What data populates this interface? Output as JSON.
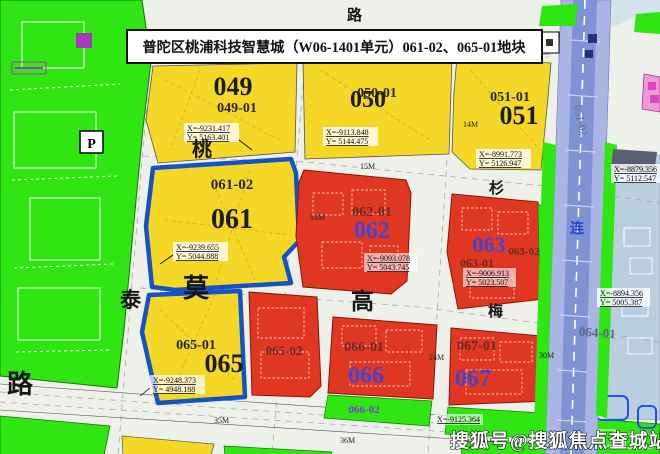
{
  "title": "普陀区桃浦科技智慧城（W06-1401单元）061-02、065-01地块",
  "watermark": "搜狐号@搜狐焦点查城站",
  "colors": {
    "parcel_yellow": "#f5d827",
    "parcel_red": "#e03723",
    "park_green": "#2fe512",
    "highlight_blue": "#1552c4",
    "railway_blue": "#a9b6e4",
    "mixed_blue_gray": "#b9cede",
    "pink": "#ef9ad8",
    "number_blue": "#4343cc"
  },
  "parcels": {
    "p049": {
      "num": "049",
      "sub": "049-01"
    },
    "p050": {
      "num": "050",
      "sub": "050-01"
    },
    "p051": {
      "num": "051",
      "sub": "051-01",
      "sub2": "051-02"
    },
    "p061": {
      "num": "061",
      "sub": "061-02"
    },
    "p062": {
      "num": "062",
      "sub": "062-01"
    },
    "p063": {
      "num": "063",
      "sub1": "063-01",
      "sub2": "063-02"
    },
    "p064": {
      "sub": "064-01"
    },
    "p065": {
      "num": "065",
      "sub": "065-01",
      "sub2": "065-02"
    },
    "p066": {
      "num": "066",
      "sub": "066-01",
      "sub2": "066-02"
    },
    "p067": {
      "num": "067",
      "sub": "067-01"
    }
  },
  "coords": {
    "c049": {
      "x": "X=-9231.417",
      "y": "Y= 5163.401"
    },
    "c050": {
      "x": "X=-9113.848",
      "y": "Y= 5144.475"
    },
    "c051": {
      "x": "X=-8991.773",
      "y": "Y= 5126.947"
    },
    "c061": {
      "x": "X=-9239.655",
      "y": "Y= 5044.888"
    },
    "c062": {
      "x": "X=-9093.078",
      "y": "Y= 5043.745"
    },
    "c063": {
      "x": "X=-9006.913",
      "y": "Y= 5023.507"
    },
    "c065": {
      "x": "X=-9248.373",
      "y": "Y= 4948.188"
    },
    "cR1": {
      "x": "X=-8879.356",
      "y": "Y= 5112.547"
    },
    "cR2": {
      "x": "X=-8894.356",
      "y": "Y= 5005.387"
    },
    "cG": {
      "x": "X=-9125.364"
    }
  },
  "widths": {
    "w14a": "14M",
    "w15": "15M",
    "w14b": "14M",
    "w24": "24M",
    "w35": "35M",
    "w36": "36M",
    "w30": "30M"
  },
  "roads": {
    "lu_top": "路",
    "tao": "桃",
    "shan": "杉",
    "tai": "泰",
    "mo": "莫",
    "gao": "高",
    "mei": "梅",
    "lu": "路",
    "lian": "连",
    "parking": "P"
  }
}
